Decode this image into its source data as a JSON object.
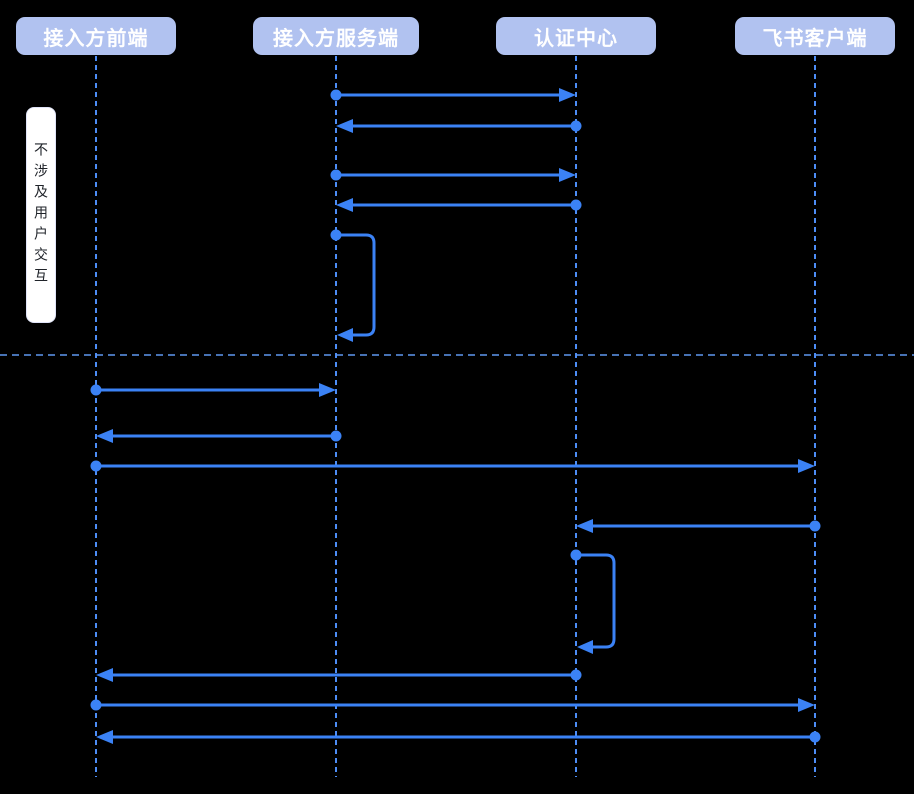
{
  "diagram": {
    "title": "",
    "canvas": {
      "width": 914,
      "height": 794,
      "background": "#000000"
    },
    "colors": {
      "arrow": "#3b82f5",
      "lifeline": "#4d8df6",
      "divider": "#5f97f0",
      "actor_fill": "#b1c2f0",
      "actor_text": "#ffffff",
      "note_bg": "#ffffff",
      "note_text": "#1f2329"
    },
    "actors": [
      {
        "id": "frontend",
        "label": "接入方前端",
        "x": 96
      },
      {
        "id": "server",
        "label": "接入方服务端",
        "x": 336
      },
      {
        "id": "auth",
        "label": "认证中心",
        "x": 576
      },
      {
        "id": "feishu",
        "label": "飞书客户端",
        "x": 815
      }
    ],
    "note": {
      "text": "不涉及用户交互",
      "x": 26,
      "y": 107,
      "width": 30,
      "height": 216
    },
    "lifeline": {
      "top": 56,
      "bottom": 777
    },
    "divider": {
      "y": 355
    },
    "messages": [
      {
        "type": "arrow",
        "from": "server",
        "to": "auth",
        "y": 95,
        "label": ""
      },
      {
        "type": "arrow",
        "from": "auth",
        "to": "server",
        "y": 126,
        "label": ""
      },
      {
        "type": "arrow",
        "from": "server",
        "to": "auth",
        "y": 175,
        "label": ""
      },
      {
        "type": "arrow",
        "from": "auth",
        "to": "server",
        "y": 205,
        "label": ""
      },
      {
        "type": "self",
        "actor": "server",
        "y1": 235,
        "y2": 335,
        "extent": 38,
        "label": ""
      },
      {
        "type": "arrow",
        "from": "frontend",
        "to": "server",
        "y": 390,
        "label": ""
      },
      {
        "type": "arrow",
        "from": "server",
        "to": "frontend",
        "y": 436,
        "label": ""
      },
      {
        "type": "arrow",
        "from": "frontend",
        "to": "feishu",
        "y": 466,
        "label": ""
      },
      {
        "type": "arrow",
        "from": "feishu",
        "to": "auth",
        "y": 526,
        "label": ""
      },
      {
        "type": "self",
        "actor": "auth",
        "y1": 555,
        "y2": 647,
        "extent": 38,
        "label": ""
      },
      {
        "type": "arrow",
        "from": "auth",
        "to": "frontend",
        "y": 675,
        "label": ""
      },
      {
        "type": "arrow",
        "from": "frontend",
        "to": "feishu",
        "y": 705,
        "label": ""
      },
      {
        "type": "arrow",
        "from": "feishu",
        "to": "frontend",
        "y": 737,
        "label": ""
      }
    ]
  }
}
